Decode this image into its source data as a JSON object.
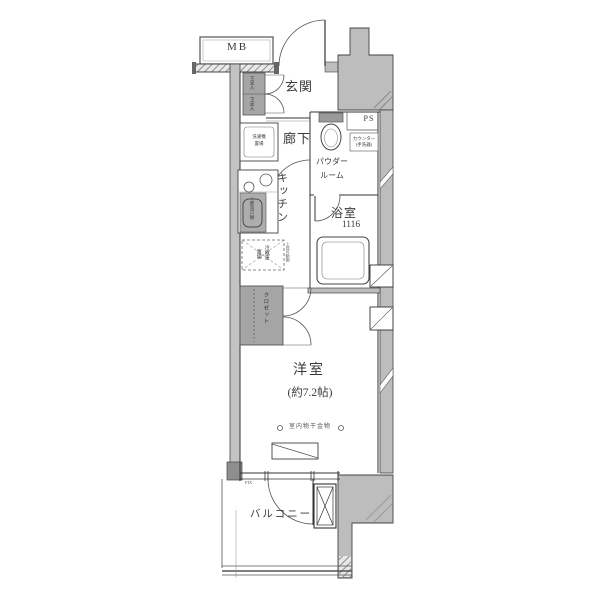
{
  "floor_plan": {
    "rooms": {
      "entrance": "玄関",
      "hallway": "廊下",
      "kitchen": "キッチン",
      "powder_room_line1": "パウダー",
      "powder_room_line2": "ルーム",
      "bathroom": "浴室",
      "bathroom_module": "1116",
      "western_room": "洋室",
      "western_room_area": "(約7.2帖)",
      "balcony": "バルコニー"
    },
    "fixtures": {
      "meter_box": "MB",
      "pipe_space": "PS",
      "shoe_cabinet_upper": "下足入",
      "shoe_cabinet_lower": "下足入",
      "washing_machine_line1": "洗濯機",
      "washing_machine_line2": "置場",
      "upper_cabinet": "上部吊戸棚",
      "refrigerator_col1": "冷蔵庫",
      "refrigerator_col2": "置場",
      "upper_shelf": "上部可動棚",
      "closet": "クロゼット",
      "counter_line1": "カウンター",
      "counter_line2": "(手洗器)",
      "indoor_drying_hardware": "室内物干金物",
      "fixed_window": "FIX"
    },
    "colors": {
      "wall": "#bdbdbd",
      "fixture": "#a5a5a5",
      "line": "#333333",
      "background": "#ffffff"
    }
  }
}
